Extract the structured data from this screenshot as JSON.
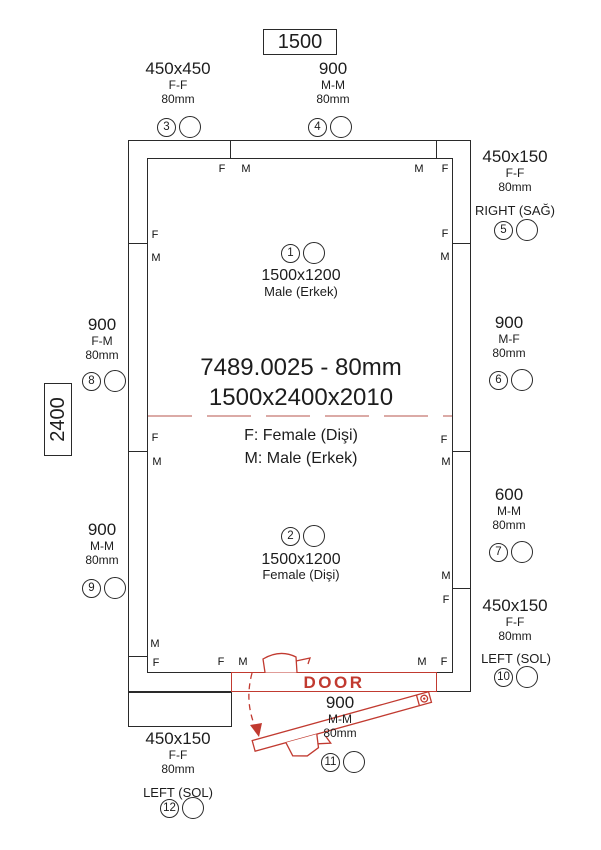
{
  "drawing": {
    "product_code": "7489.0025 - 80mm",
    "dimensions": "1500x2400x2010",
    "legend_female": "F: Female (Dişi)",
    "legend_male": "M: Male (Erkek)",
    "width_label": "1500",
    "height_label": "2400",
    "door_label": "DOOR"
  },
  "edge_labels": {
    "f": "F",
    "m": "M"
  },
  "panels": [
    {
      "id": "1",
      "size": "1500x1200",
      "type": "Male (Erkek)"
    },
    {
      "id": "2",
      "size": "1500x1200",
      "type": "Female (Dişi)"
    },
    {
      "id": "3",
      "size": "450x450",
      "joint": "F-F",
      "thickness": "80mm"
    },
    {
      "id": "4",
      "size": "900",
      "joint": "M-M",
      "thickness": "80mm"
    },
    {
      "id": "5",
      "size": "450x150",
      "joint": "F-F",
      "thickness": "80mm",
      "orientation": "RIGHT (SAĞ)"
    },
    {
      "id": "6",
      "size": "900",
      "joint": "M-F",
      "thickness": "80mm"
    },
    {
      "id": "7",
      "size": "600",
      "joint": "M-M",
      "thickness": "80mm"
    },
    {
      "id": "8",
      "size": "900",
      "joint": "F-M",
      "thickness": "80mm"
    },
    {
      "id": "9",
      "size": "900",
      "joint": "M-M",
      "thickness": "80mm"
    },
    {
      "id": "10",
      "size": "450x150",
      "joint": "F-F",
      "thickness": "80mm",
      "orientation": "LEFT (SOL)"
    },
    {
      "id": "11",
      "size": "900",
      "joint": "M-M",
      "thickness": "80mm"
    },
    {
      "id": "12",
      "size": "450x150",
      "joint": "F-F",
      "thickness": "80mm",
      "orientation": "LEFT (SOL)"
    }
  ],
  "colors": {
    "line": "#2a2a2a",
    "red": "#c13a30",
    "dashed_red": "#cf8d88"
  }
}
